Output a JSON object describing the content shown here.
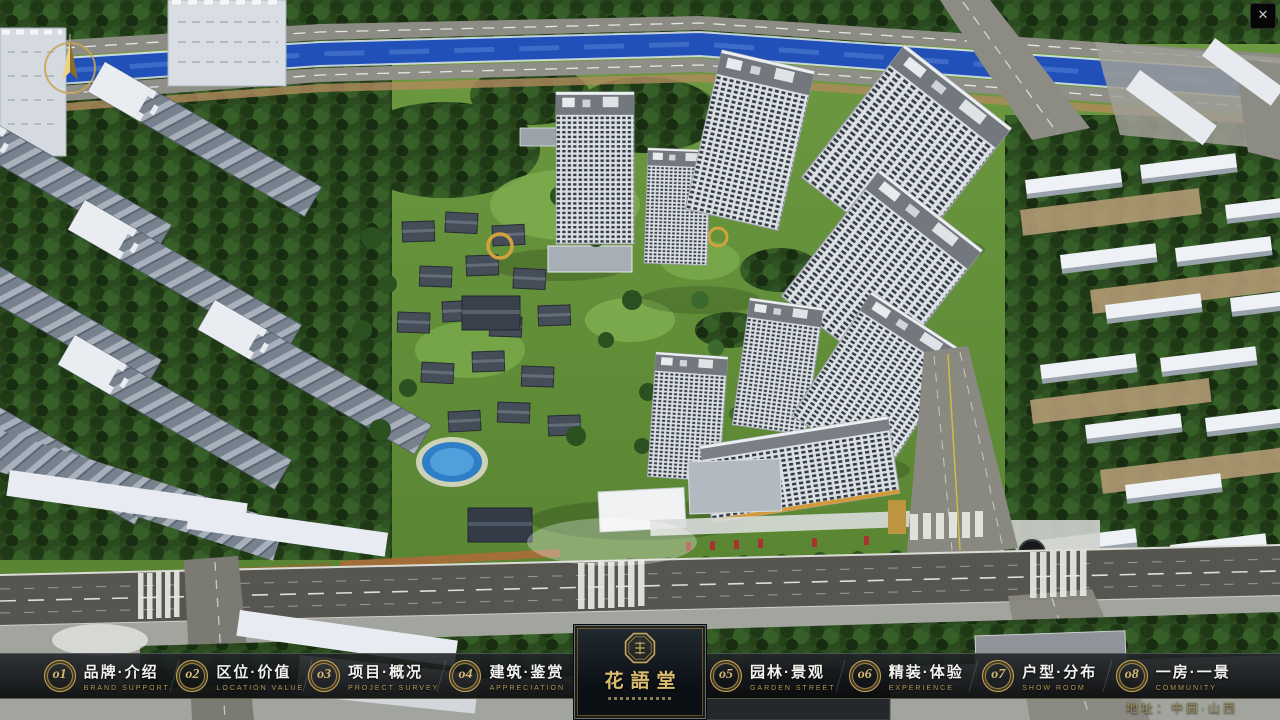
{
  "window": {
    "close_glyph": "✕"
  },
  "navbar": {
    "items": [
      {
        "num": "o1",
        "title": "品牌·介绍",
        "subtitle": "BRAND SUPPORT"
      },
      {
        "num": "o2",
        "title": "区位·价值",
        "subtitle": "LOCATION VALUE"
      },
      {
        "num": "o3",
        "title": "项目·概况",
        "subtitle": "PROJECT SURVEY"
      },
      {
        "num": "o4",
        "title": "建筑·鉴赏",
        "subtitle": "APPRECIATION"
      },
      {
        "num": "o5",
        "title": "园林·景观",
        "subtitle": "GARDEN STREET"
      },
      {
        "num": "o6",
        "title": "精装·体验",
        "subtitle": "EXPERIENCE"
      },
      {
        "num": "o7",
        "title": "户型·分布",
        "subtitle": "SHOW ROOM"
      },
      {
        "num": "o8",
        "title": "一房·一景",
        "subtitle": "COMMUNITY"
      }
    ],
    "logo_title": "花語堂"
  },
  "footer": {
    "address": "地址：中国·山西"
  },
  "colors": {
    "gold": "#c9a85c",
    "river_blue": "#2050b8",
    "lawn_green": "#6d9a41",
    "bar_background": "#0c0e10",
    "road_gray": "#8d8c84"
  }
}
